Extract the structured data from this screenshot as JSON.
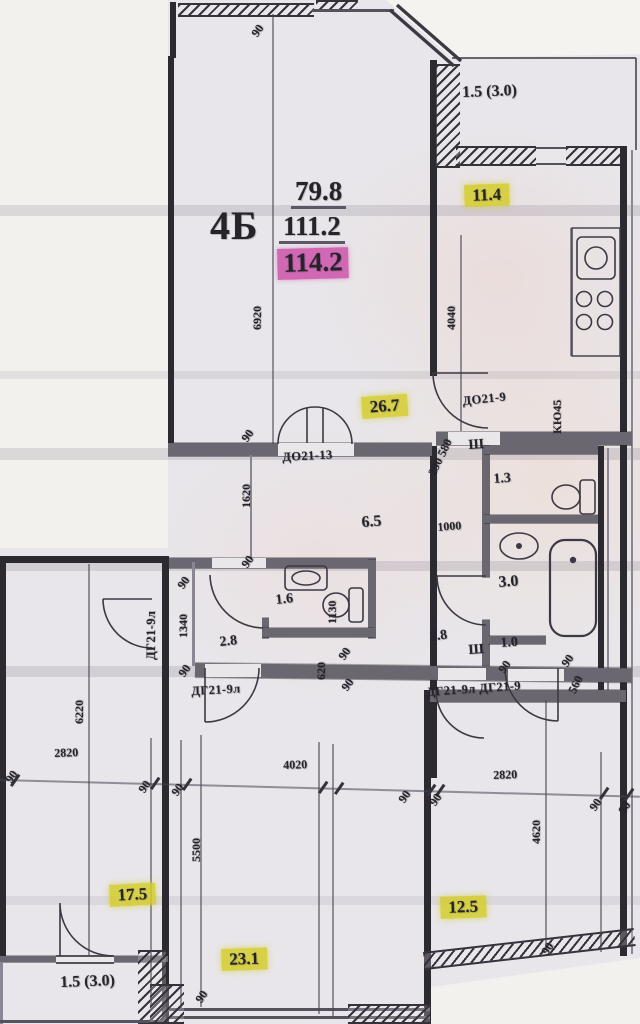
{
  "apartment": {
    "type_label": "4Б",
    "living_area": "79.8",
    "apartment_area": "111.2",
    "total_area": "114.2"
  },
  "highlighted_room_areas": [
    "11.4",
    "26.7",
    "17.5",
    "23.1",
    "12.5"
  ],
  "balcony_areas": [
    "1.5 (3.0)",
    "1.5 (3.0)"
  ],
  "other_room_areas": [
    "6.5",
    "1.3",
    "3.0",
    "3.8",
    "1.0",
    "1.6",
    "2.8"
  ],
  "door_labels": [
    "ДО21-13",
    "ДО21-9",
    "ДГ21-9л",
    "ДГ21-9л ДГ21-9",
    "ДГ21-9л"
  ],
  "unit_labels": [
    "КЮ45",
    "Ш",
    "Ш"
  ],
  "dimension_labels": [
    "6920",
    "4040",
    "1000",
    "1130",
    "1620",
    "1340",
    "620",
    "560",
    "290 580",
    "6220",
    "2820",
    "4020",
    "2820",
    "5500",
    "4620",
    "90"
  ],
  "colors": {
    "highlight_yellow": "#d4cd2c",
    "highlight_pink": "#cb4ca8",
    "paper": "#e8e6ea",
    "ink": "#26242a"
  },
  "labels": [
    {
      "n": "apartment-type-label",
      "t": "4Б",
      "x": 210,
      "y": 206,
      "cls": "apt"
    },
    {
      "n": "living-area-value",
      "t": "79.8",
      "x": 291,
      "y": 178,
      "cls": "big"
    },
    {
      "n": "apartment-area-value",
      "t": "111.2",
      "x": 279,
      "y": 213,
      "cls": "big"
    },
    {
      "n": "total-area-value",
      "t": "114.2",
      "x": 277,
      "y": 249,
      "cls": "pink",
      "rot": -1.5
    },
    {
      "n": "kitchen-area-value",
      "t": "11.4",
      "x": 464,
      "y": 185,
      "cls": "area hl",
      "rot": -2
    },
    {
      "n": "living-room-area-value",
      "t": "26.7",
      "x": 361,
      "y": 397,
      "cls": "area hl",
      "rot": -4
    },
    {
      "n": "room-area-value",
      "t": "17.5",
      "x": 109,
      "y": 885,
      "cls": "area hl",
      "rot": -3
    },
    {
      "n": "room-area-value",
      "t": "12.5",
      "x": 440,
      "y": 897,
      "cls": "area hl",
      "rot": -2
    },
    {
      "n": "room-area-value",
      "t": "23.1",
      "x": 221,
      "y": 949,
      "cls": "area hl",
      "rot": -2
    },
    {
      "n": "balcony-area-value",
      "t": "1.5 (3.0)",
      "x": 462,
      "y": 85,
      "cls": "med",
      "rot": -2
    },
    {
      "n": "balcony-area-value",
      "t": "1.5 (3.0)",
      "x": 60,
      "y": 975,
      "cls": "med",
      "rot": -2
    },
    {
      "n": "hall-area-value",
      "t": "6.5",
      "x": 361,
      "y": 515,
      "cls": "med",
      "rot": -4
    },
    {
      "n": "wc-area-value",
      "t": "1.3",
      "x": 493,
      "y": 473,
      "cls": "sm",
      "rot": -4
    },
    {
      "n": "bath-area-value",
      "t": "3.0",
      "x": 498,
      "y": 575,
      "cls": "med",
      "rot": -4
    },
    {
      "n": "corridor-area-value",
      "t": "3.8",
      "x": 429,
      "y": 631,
      "cls": "sm",
      "rot": -8
    },
    {
      "n": "closet-area-value",
      "t": "1.0",
      "x": 500,
      "y": 637,
      "cls": "sm",
      "rot": -4
    },
    {
      "n": "wc2-area-value",
      "t": "1.6",
      "x": 275,
      "y": 594,
      "cls": "sm",
      "rot": -6
    },
    {
      "n": "hall2-area-value",
      "t": "2.8",
      "x": 219,
      "y": 636,
      "cls": "sm",
      "rot": -6
    },
    {
      "n": "door-label",
      "t": "ДО21-13",
      "x": 282,
      "y": 451,
      "cls": "door",
      "rot": -3
    },
    {
      "n": "door-label",
      "t": "ДО21-9",
      "x": 462,
      "y": 395,
      "cls": "door",
      "rot": -6
    },
    {
      "n": "door-label",
      "t": "ДГ21-9л",
      "x": 191,
      "y": 685,
      "cls": "door",
      "rot": -3
    },
    {
      "n": "door-label",
      "t": "ДГ21-9л ДГ21-9",
      "x": 426,
      "y": 686,
      "cls": "door",
      "rot": -4
    },
    {
      "n": "door-label",
      "t": "ДГ21-9л",
      "x": 145,
      "y": 660,
      "cls": "door",
      "rot": -90
    },
    {
      "n": "closet-symbol",
      "t": "Ш",
      "x": 468,
      "y": 439,
      "cls": "sm",
      "rot": -4
    },
    {
      "n": "closet-symbol",
      "t": "Ш",
      "x": 468,
      "y": 644,
      "cls": "sm",
      "rot": -4
    },
    {
      "n": "kitchen-unit-label",
      "t": "КЮ45",
      "x": 551,
      "y": 434,
      "cls": "dim",
      "rot": -90
    },
    {
      "n": "dimension",
      "t": "90",
      "x": 249,
      "y": 32,
      "cls": "dim",
      "rot": -55
    },
    {
      "n": "dimension",
      "t": "6920",
      "x": 251,
      "y": 330,
      "cls": "dim",
      "rot": -90
    },
    {
      "n": "dimension",
      "t": "4040",
      "x": 445,
      "y": 330,
      "cls": "dim",
      "rot": -90
    },
    {
      "n": "dimension",
      "t": "290 580",
      "x": 426,
      "y": 472,
      "cls": "dim",
      "rot": -64
    },
    {
      "n": "dimension",
      "t": "1000",
      "x": 437,
      "y": 521,
      "cls": "dim",
      "rot": -4
    },
    {
      "n": "dimension",
      "t": "90",
      "x": 239,
      "y": 437,
      "cls": "dim",
      "rot": -55
    },
    {
      "n": "dimension",
      "t": "1620",
      "x": 240,
      "y": 508,
      "cls": "dim",
      "rot": -90
    },
    {
      "n": "dimension",
      "t": "90",
      "x": 239,
      "y": 563,
      "cls": "dim",
      "rot": -55
    },
    {
      "n": "dimension",
      "t": "90",
      "x": 175,
      "y": 584,
      "cls": "dim",
      "rot": -55
    },
    {
      "n": "dimension",
      "t": "1340",
      "x": 177,
      "y": 638,
      "cls": "dim",
      "rot": -90
    },
    {
      "n": "dimension",
      "t": "90",
      "x": 176,
      "y": 672,
      "cls": "dim",
      "rot": -55
    },
    {
      "n": "dimension",
      "t": "1130",
      "x": 326,
      "y": 624,
      "cls": "dim",
      "rot": -90
    },
    {
      "n": "dimension",
      "t": "620",
      "x": 315,
      "y": 680,
      "cls": "dim",
      "rot": -90
    },
    {
      "n": "dimension",
      "t": "90",
      "x": 336,
      "y": 655,
      "cls": "dim",
      "rot": -55
    },
    {
      "n": "dimension",
      "t": "90",
      "x": 339,
      "y": 686,
      "cls": "dim",
      "rot": -55
    },
    {
      "n": "dimension",
      "t": "90",
      "x": 496,
      "y": 668,
      "cls": "dim",
      "rot": -55
    },
    {
      "n": "dimension",
      "t": "90",
      "x": 559,
      "y": 662,
      "cls": "dim",
      "rot": -55
    },
    {
      "n": "dimension",
      "t": "560",
      "x": 566,
      "y": 690,
      "cls": "dim",
      "rot": -64
    },
    {
      "n": "dimension",
      "t": "90",
      "x": 3,
      "y": 778,
      "cls": "dim",
      "rot": -55
    },
    {
      "n": "dimension",
      "t": "2820",
      "x": 54,
      "y": 747,
      "cls": "dim",
      "rot": -2
    },
    {
      "n": "dimension",
      "t": "90",
      "x": 136,
      "y": 788,
      "cls": "dim",
      "rot": -55
    },
    {
      "n": "dimension",
      "t": "90",
      "x": 169,
      "y": 791,
      "cls": "dim",
      "rot": -55
    },
    {
      "n": "dimension",
      "t": "4020",
      "x": 283,
      "y": 759,
      "cls": "dim",
      "rot": -2
    },
    {
      "n": "dimension",
      "t": "90",
      "x": 396,
      "y": 798,
      "cls": "dim",
      "rot": -55
    },
    {
      "n": "dimension",
      "t": "90",
      "x": 427,
      "y": 801,
      "cls": "dim",
      "rot": -55
    },
    {
      "n": "dimension",
      "t": "2820",
      "x": 493,
      "y": 769,
      "cls": "dim",
      "rot": -2
    },
    {
      "n": "dimension",
      "t": "90",
      "x": 587,
      "y": 806,
      "cls": "dim",
      "rot": -55
    },
    {
      "n": "dimension",
      "t": "90",
      "x": 616,
      "y": 809,
      "cls": "dim",
      "rot": -55
    },
    {
      "n": "dimension",
      "t": "6220",
      "x": 73,
      "y": 724,
      "cls": "dim",
      "rot": -90
    },
    {
      "n": "dimension",
      "t": "5500",
      "x": 190,
      "y": 862,
      "cls": "dim",
      "rot": -90
    },
    {
      "n": "dimension",
      "t": "4620",
      "x": 530,
      "y": 844,
      "cls": "dim",
      "rot": -90
    },
    {
      "n": "dimension",
      "t": "90",
      "x": 193,
      "y": 998,
      "cls": "dim",
      "rot": -55
    },
    {
      "n": "dimension",
      "t": "90",
      "x": 539,
      "y": 950,
      "cls": "dim",
      "rot": -55
    }
  ]
}
